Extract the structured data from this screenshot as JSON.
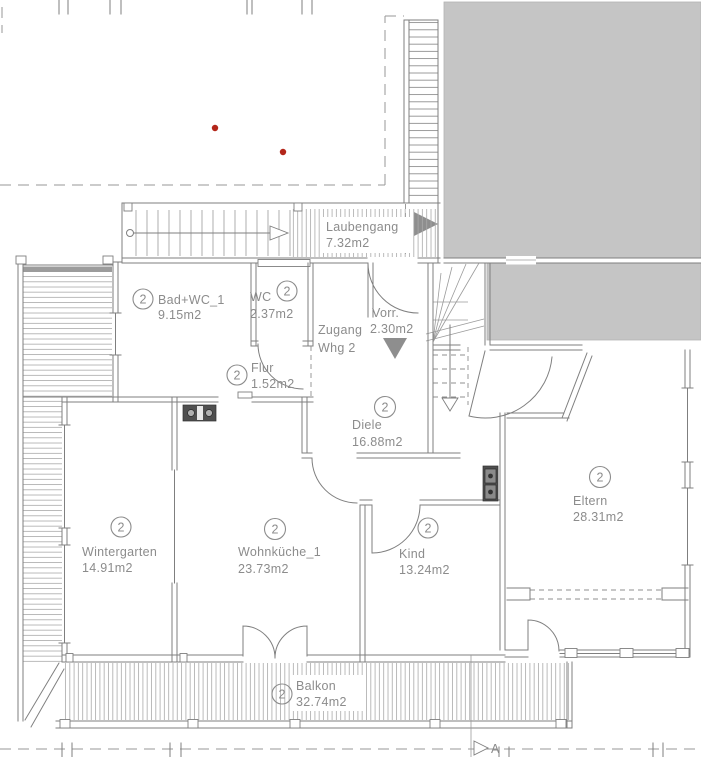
{
  "unit": "2",
  "rooms": [
    {
      "name": "Laubengang",
      "area": "7.32m2"
    },
    {
      "name": "Bad+WC_1",
      "area": "9.15m2"
    },
    {
      "name": "WC",
      "area": "2.37m2"
    },
    {
      "name": "Zugang",
      "line2": "Whg 2"
    },
    {
      "name": "Vorr.",
      "area": "2.30m2"
    },
    {
      "name": "Flur",
      "area": "1.52m2"
    },
    {
      "name": "Diele",
      "area": "16.88m2"
    },
    {
      "name": "Wintergarten",
      "area": "14.91m2"
    },
    {
      "name": "Wohnküche_1",
      "area": "23.73m2"
    },
    {
      "name": "Kind",
      "area": "13.24m2"
    },
    {
      "name": "Eltern",
      "area": "28.31m2"
    },
    {
      "name": "Balkon",
      "area": "32.74m2"
    }
  ],
  "section_marker": "A",
  "colors": {
    "wall": "#7f7f7f",
    "text": "#8c8c8c",
    "building_mass": "#c5c5c5",
    "marker_red": "#b3261a",
    "arrow_gray": "#8e8e8e"
  }
}
